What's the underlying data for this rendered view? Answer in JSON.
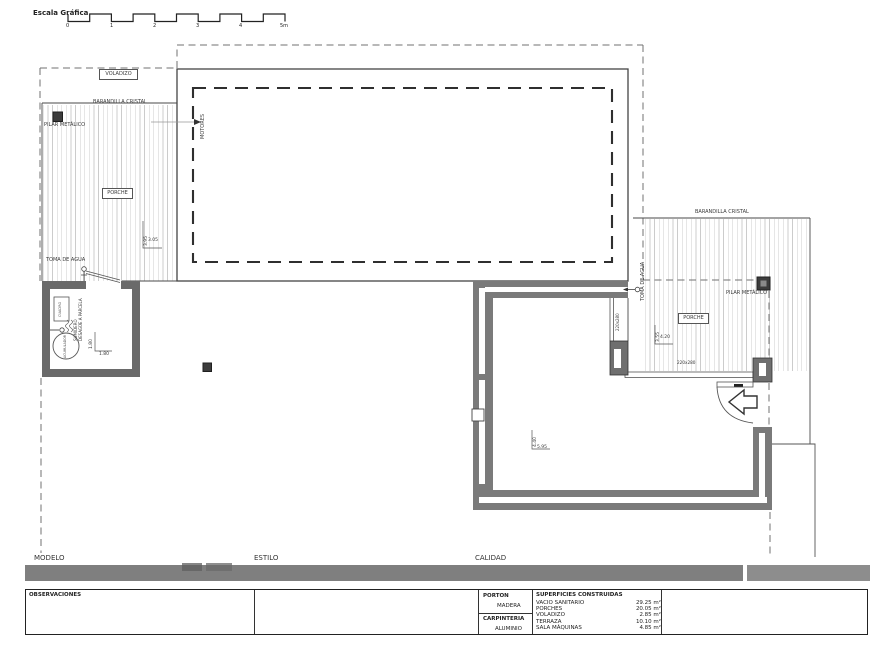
{
  "scale_bar": {
    "label": "Escala Gráfica",
    "ticks": [
      "0",
      "1",
      "2",
      "3",
      "4",
      "5m"
    ]
  },
  "plan": {
    "voladizo": "VOLADIZO",
    "barandilla_left": "BARANDILLA CRISTAL",
    "barandilla_right": "BARANDILLA CRISTAL",
    "pilar_left": "PILAR METÁLICO",
    "pilar_right": "PILAR METÁLICO",
    "porche_left": "PORCHE",
    "porche_right": "PORCHE",
    "motores": "MOTORES",
    "toma_left": "TOMA DE AGUA",
    "toma_right": "TOMA DE AGUA",
    "window_tag": "220x280",
    "window_tag_side": "220x280",
    "dims": {
      "porch_left_v": "3.95",
      "porch_left_h": "3.05",
      "porch_right_v": "3.55",
      "porch_right_h": "4.20",
      "terraza_v": "4.40",
      "terraza_h": "5.95",
      "room_v": "1.80",
      "room_h": "1.80"
    },
    "room": {
      "panel": "CUADRO",
      "tank": "ACUMULADOR",
      "drain": "SUMIDERO\nDESAGÜE A PARCELA"
    }
  },
  "footer": {
    "modelo": "MODELO",
    "estilo": "ESTILO",
    "calidad": "CALIDAD",
    "observaciones": "OBSERVACIONES",
    "porton": "PORTON",
    "madera": "MADERA",
    "carpinteria": "CARPINTERIA",
    "aluminio": "ALUMINIO",
    "superficies_title": "SUPERFICIES CONSTRUIDAS",
    "superficies": [
      {
        "name": "VACIO SANITARIO",
        "value": "29.25 m²"
      },
      {
        "name": "PORCHES",
        "value": "20.05 m²"
      },
      {
        "name": "VOLADIZO",
        "value": "2.85 m²"
      },
      {
        "name": "TERRAZA",
        "value": "10.10 m²"
      },
      {
        "name": "SALA MÁQUINAS",
        "value": "4.85 m²"
      }
    ]
  }
}
